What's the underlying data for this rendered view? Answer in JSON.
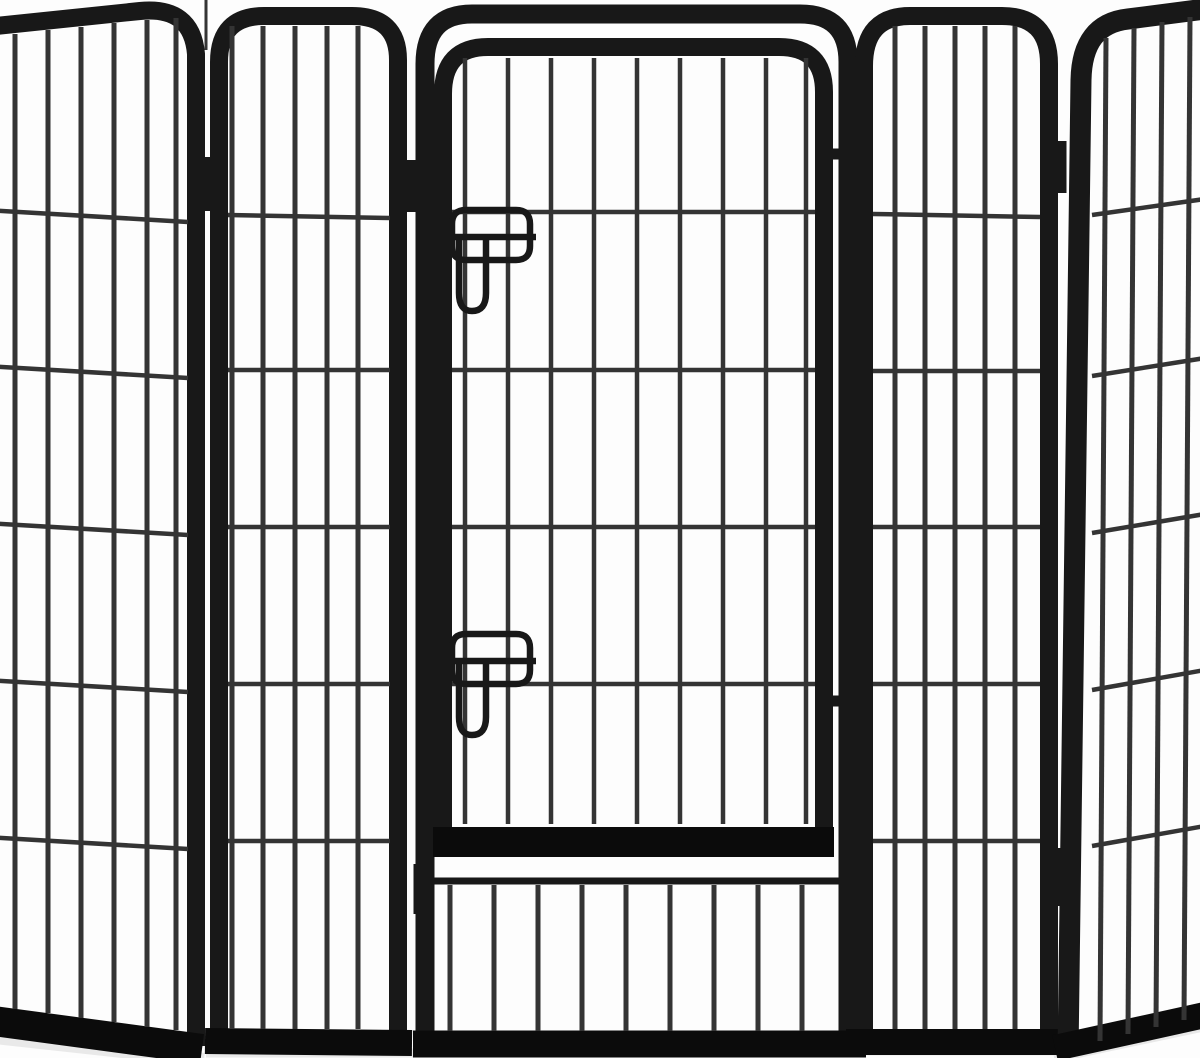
{
  "scene": {
    "alt": "Black metal heavy-duty pet playpen: five wire panels, center panel with latched door",
    "canvas": {
      "width": 1200,
      "height": 1058
    },
    "colors": {
      "background": "#fdfdfd",
      "frame": "#181818",
      "rail": "#0b0b0b",
      "wire": "#343434",
      "shadow": "#e9e9e9"
    },
    "groups": [
      {
        "name": "floor-shadows",
        "shapes": [
          {
            "n": "shadow",
            "d": "M -14 1036 L 204 1060",
            "w": 14,
            "c": "shadow"
          },
          {
            "n": "shadow",
            "d": "M 206 1053 L 866 1053",
            "w": 9,
            "c": "shadow"
          },
          {
            "n": "shadow",
            "d": "M 846 1051 L 1064 1051",
            "w": 9,
            "c": "shadow"
          },
          {
            "n": "shadow",
            "d": "M 1054 1057 L 1206 1025",
            "w": 12,
            "c": "shadow"
          }
        ]
      },
      {
        "name": "left-return-panel",
        "shapes": [
          {
            "n": "panel-frame",
            "d": "M -14 27 L 140 11 Q 192 6 196 54 L 196 1046",
            "w": 18,
            "c": "frame"
          },
          {
            "n": "bottom-rail",
            "d": "M -14 1020 L 202 1049",
            "w": 30,
            "c": "rail"
          },
          {
            "n": "wire-vertical",
            "d": "M 15 34 L 15 1009",
            "w": 5,
            "c": "wire"
          },
          {
            "n": "wire-vertical",
            "d": "M 48 30 L 48 1013",
            "w": 5,
            "c": "wire"
          },
          {
            "n": "wire-vertical",
            "d": "M 81 27 L 81 1018",
            "w": 5,
            "c": "wire"
          },
          {
            "n": "wire-vertical",
            "d": "M 114 23 L 114 1022",
            "w": 5,
            "c": "wire"
          },
          {
            "n": "wire-vertical",
            "d": "M 147 20 L 147 1027",
            "w": 5,
            "c": "wire"
          },
          {
            "n": "wire-vertical",
            "d": "M 176 18 L 176 1030",
            "w": 5,
            "c": "wire"
          },
          {
            "n": "wire-horizontal",
            "d": "M -14 210 L 188 222",
            "w": 4.5,
            "c": "wire"
          },
          {
            "n": "wire-horizontal",
            "d": "M -14 366 L 188 378",
            "w": 4.5,
            "c": "wire"
          },
          {
            "n": "wire-horizontal",
            "d": "M -14 523 L 188 535",
            "w": 4.5,
            "c": "wire"
          },
          {
            "n": "wire-horizontal",
            "d": "M -14 680 L 188 692",
            "w": 4.5,
            "c": "wire"
          },
          {
            "n": "wire-horizontal",
            "d": "M -14 837 L 188 849",
            "w": 4.5,
            "c": "wire"
          }
        ]
      },
      {
        "name": "left-panel",
        "shapes": [
          {
            "n": "panel-frame",
            "d": "M 219 1042 L 219 62 Q 219 16 264 16 L 352 16 Q 398 16 398 60 L 398 1042",
            "w": 18,
            "c": "frame"
          },
          {
            "n": "bottom-rail",
            "d": "M 205 1041 L 412 1043",
            "w": 26,
            "c": "rail"
          },
          {
            "n": "wire-vertical",
            "d": "M 232 26 L 232 1029",
            "w": 5,
            "c": "wire"
          },
          {
            "n": "wire-vertical",
            "d": "M 263 26 L 263 1029",
            "w": 5,
            "c": "wire"
          },
          {
            "n": "wire-vertical",
            "d": "M 295 26 L 295 1029",
            "w": 5,
            "c": "wire"
          },
          {
            "n": "wire-vertical",
            "d": "M 327 26 L 327 1029",
            "w": 5,
            "c": "wire"
          },
          {
            "n": "wire-vertical",
            "d": "M 358 26 L 358 1029",
            "w": 5,
            "c": "wire"
          },
          {
            "n": "wire-horizontal",
            "d": "M 228 215 L 390 218",
            "w": 4.5,
            "c": "wire"
          },
          {
            "n": "wire-horizontal",
            "d": "M 228 370 L 390 370",
            "w": 4.5,
            "c": "wire"
          },
          {
            "n": "wire-horizontal",
            "d": "M 228 527 L 390 527",
            "w": 4.5,
            "c": "wire"
          },
          {
            "n": "wire-horizontal",
            "d": "M 228 684 L 390 684",
            "w": 4.5,
            "c": "wire"
          },
          {
            "n": "wire-horizontal",
            "d": "M 228 841 L 390 841",
            "w": 4.5,
            "c": "wire"
          }
        ]
      },
      {
        "name": "door-panel",
        "shapes": [
          {
            "n": "panel-frame",
            "d": "M 425 1043 L 425 64 Q 425 14 472 14 L 800 14 Q 848 14 848 62 L 848 1043",
            "w": 19,
            "c": "frame"
          },
          {
            "n": "bottom-rail",
            "d": "M 413 1044 L 866 1044",
            "w": 27,
            "c": "rail"
          },
          {
            "n": "lower-section-rail",
            "d": "M 434 881 L 846 881",
            "w": 7,
            "c": "frame"
          },
          {
            "n": "wire-vertical",
            "d": "M 450 885 L 450 1031",
            "w": 5,
            "c": "wire"
          },
          {
            "n": "wire-vertical",
            "d": "M 494 885 L 494 1031",
            "w": 5,
            "c": "wire"
          },
          {
            "n": "wire-vertical",
            "d": "M 538 885 L 538 1031",
            "w": 5,
            "c": "wire"
          },
          {
            "n": "wire-vertical",
            "d": "M 582 885 L 582 1031",
            "w": 5,
            "c": "wire"
          },
          {
            "n": "wire-vertical",
            "d": "M 626 885 L 626 1031",
            "w": 5,
            "c": "wire"
          },
          {
            "n": "wire-vertical",
            "d": "M 670 885 L 670 1031",
            "w": 5,
            "c": "wire"
          },
          {
            "n": "wire-vertical",
            "d": "M 714 885 L 714 1031",
            "w": 5,
            "c": "wire"
          },
          {
            "n": "wire-vertical",
            "d": "M 758 885 L 758 1031",
            "w": 5,
            "c": "wire"
          },
          {
            "n": "wire-vertical",
            "d": "M 802 885 L 802 1031",
            "w": 5,
            "c": "wire"
          },
          {
            "n": "door-frame",
            "d": "M 443 851 L 443 94 Q 443 47 488 47 L 779 47 Q 824 47 824 92 L 824 851",
            "w": 18,
            "c": "frame"
          },
          {
            "n": "door-bottom-rail",
            "d": "M 433 842 L 834 842",
            "w": 30,
            "c": "rail"
          },
          {
            "n": "wire-vertical",
            "d": "M 465 58 L 465 824",
            "w": 4.5,
            "c": "wire"
          },
          {
            "n": "wire-vertical",
            "d": "M 508 58 L 508 824",
            "w": 4.5,
            "c": "wire"
          },
          {
            "n": "wire-vertical",
            "d": "M 551 58 L 551 824",
            "w": 4.5,
            "c": "wire"
          },
          {
            "n": "wire-vertical",
            "d": "M 594 58 L 594 824",
            "w": 4.5,
            "c": "wire"
          },
          {
            "n": "wire-vertical",
            "d": "M 637 58 L 637 824",
            "w": 4.5,
            "c": "wire"
          },
          {
            "n": "wire-vertical",
            "d": "M 680 58 L 680 824",
            "w": 4.5,
            "c": "wire"
          },
          {
            "n": "wire-vertical",
            "d": "M 723 58 L 723 824",
            "w": 4.5,
            "c": "wire"
          },
          {
            "n": "wire-vertical",
            "d": "M 766 58 L 766 824",
            "w": 4.5,
            "c": "wire"
          },
          {
            "n": "wire-vertical",
            "d": "M 806 58 L 806 824",
            "w": 4.5,
            "c": "wire"
          },
          {
            "n": "wire-horizontal",
            "d": "M 452 212 L 815 212",
            "w": 4.5,
            "c": "wire"
          },
          {
            "n": "wire-horizontal",
            "d": "M 452 370 L 815 370",
            "w": 4.5,
            "c": "wire"
          },
          {
            "n": "wire-horizontal",
            "d": "M 452 527 L 815 527",
            "w": 4.5,
            "c": "wire"
          },
          {
            "n": "wire-horizontal",
            "d": "M 452 684 L 815 684",
            "w": 4.5,
            "c": "wire"
          },
          {
            "n": "door-hinge",
            "d": "M 822 154 L 854 154",
            "w": 11,
            "c": "frame"
          },
          {
            "n": "door-hinge",
            "d": "M 822 701 L 854 701",
            "w": 11,
            "c": "frame"
          },
          {
            "n": "latch-loop-top",
            "d": "M 466 210 L 516 210 Q 530 210 530 224 L 530 246 Q 530 260 516 260 L 466 260 Q 452 260 452 246 L 452 224 Q 452 210 466 210",
            "w": 6.5,
            "c": "frame"
          },
          {
            "n": "latch-bar-top",
            "d": "M 416 237 L 536 237",
            "w": 6.5,
            "c": "frame"
          },
          {
            "n": "latch-slider-top",
            "d": "M 459 240 L 459 293 Q 459 311 472 311 Q 486 311 486 293 L 486 240",
            "w": 6.5,
            "c": "frame"
          },
          {
            "n": "latch-loop-bottom",
            "d": "M 466 634 L 516 634 Q 530 634 530 648 L 530 670 Q 530 684 516 684 L 466 684 Q 452 684 452 670 L 452 648 Q 452 634 466 634",
            "w": 6.5,
            "c": "frame"
          },
          {
            "n": "latch-bar-bottom",
            "d": "M 416 661 L 536 661",
            "w": 6.5,
            "c": "frame"
          },
          {
            "n": "latch-slider-bottom",
            "d": "M 459 664 L 459 717 Q 459 735 472 735 Q 486 735 486 717 L 486 664",
            "w": 6.5,
            "c": "frame"
          }
        ]
      },
      {
        "name": "right-panel",
        "shapes": [
          {
            "n": "panel-frame",
            "d": "M 864 1042 L 864 66 Q 864 16 910 16 L 1002 16 Q 1049 16 1049 64 L 1049 1042",
            "w": 18,
            "c": "frame"
          },
          {
            "n": "bottom-rail",
            "d": "M 846 1042 L 1062 1042",
            "w": 26,
            "c": "rail"
          },
          {
            "n": "wire-vertical",
            "d": "M 895 26 L 895 1029",
            "w": 5,
            "c": "wire"
          },
          {
            "n": "wire-vertical",
            "d": "M 925 26 L 925 1029",
            "w": 5,
            "c": "wire"
          },
          {
            "n": "wire-vertical",
            "d": "M 955 26 L 955 1029",
            "w": 5,
            "c": "wire"
          },
          {
            "n": "wire-vertical",
            "d": "M 985 26 L 985 1029",
            "w": 5,
            "c": "wire"
          },
          {
            "n": "wire-vertical",
            "d": "M 1015 26 L 1015 1029",
            "w": 5,
            "c": "wire"
          },
          {
            "n": "wire-horizontal",
            "d": "M 873 214 L 1040 217",
            "w": 4.5,
            "c": "wire"
          },
          {
            "n": "wire-horizontal",
            "d": "M 873 371 L 1040 371",
            "w": 4.5,
            "c": "wire"
          },
          {
            "n": "wire-horizontal",
            "d": "M 873 527 L 1040 527",
            "w": 4.5,
            "c": "wire"
          },
          {
            "n": "wire-horizontal",
            "d": "M 873 684 L 1040 684",
            "w": 4.5,
            "c": "wire"
          },
          {
            "n": "wire-horizontal",
            "d": "M 873 841 L 1040 841",
            "w": 4.5,
            "c": "wire"
          }
        ]
      },
      {
        "name": "right-return-panel",
        "shapes": [
          {
            "n": "panel-frame",
            "d": "M 1068 1054 L 1081 80 Q 1082 24 1128 19 L 1205 9",
            "w": 21,
            "c": "frame"
          },
          {
            "n": "bottom-rail",
            "d": "M 1055 1048 L 1205 1015",
            "w": 26,
            "c": "rail"
          },
          {
            "n": "wire-vertical",
            "d": "M 1106 38 L 1100 1041",
            "w": 5,
            "c": "wire"
          },
          {
            "n": "wire-vertical",
            "d": "M 1134 28 L 1128 1034",
            "w": 5,
            "c": "wire"
          },
          {
            "n": "wire-vertical",
            "d": "M 1162 22 L 1156 1027",
            "w": 5,
            "c": "wire"
          },
          {
            "n": "wire-vertical",
            "d": "M 1190 17 L 1184 1020",
            "w": 5,
            "c": "wire"
          },
          {
            "n": "wire-horizontal",
            "d": "M 1092 215 L 1205 199",
            "w": 4.5,
            "c": "wire"
          },
          {
            "n": "wire-horizontal",
            "d": "M 1092 376 L 1205 358",
            "w": 4.5,
            "c": "wire"
          },
          {
            "n": "wire-horizontal",
            "d": "M 1092 533 L 1205 514",
            "w": 4.5,
            "c": "wire"
          },
          {
            "n": "wire-horizontal",
            "d": "M 1092 690 L 1205 670",
            "w": 4.5,
            "c": "wire"
          },
          {
            "n": "wire-horizontal",
            "d": "M 1092 846 L 1205 826",
            "w": 4.5,
            "c": "wire"
          }
        ]
      },
      {
        "name": "panel-hinges",
        "shapes": [
          {
            "n": "hinge-seam",
            "d": "M 206 0 L 206 50",
            "w": 3,
            "c": "wire"
          },
          {
            "n": "hinge-knuckle",
            "d": "M 207 157 L 207 211",
            "w": 13,
            "c": "frame"
          },
          {
            "n": "hinge-knuckle",
            "d": "M 196 862 L 196 912",
            "w": 18,
            "c": "frame"
          },
          {
            "n": "hinge-knuckle",
            "d": "M 412 160 L 412 212",
            "w": 13,
            "c": "frame"
          },
          {
            "n": "hinge-knuckle",
            "d": "M 421 864 L 421 914",
            "w": 15,
            "c": "frame"
          },
          {
            "n": "hinge-knuckle",
            "d": "M 1059 141 L 1059 193",
            "w": 15,
            "c": "frame"
          },
          {
            "n": "hinge-knuckle",
            "d": "M 1056 848 L 1056 906",
            "w": 24,
            "c": "frame"
          }
        ]
      }
    ]
  }
}
